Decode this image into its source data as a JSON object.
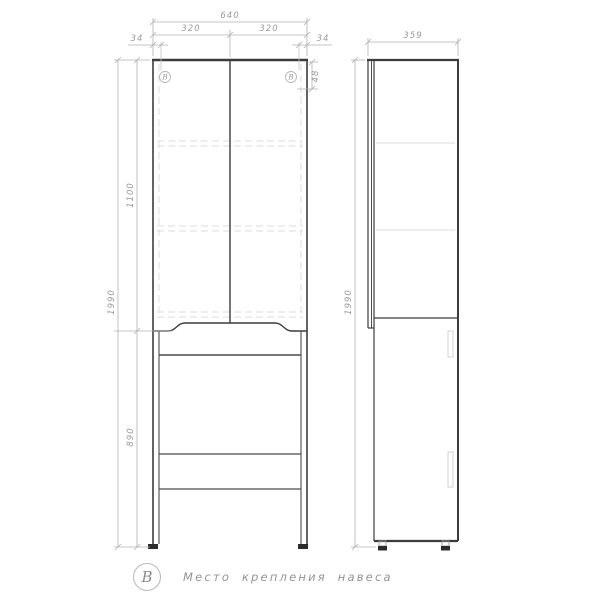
{
  "front_view": {
    "dim_width_total": "640",
    "dim_door_left": "320",
    "dim_door_right": "320",
    "dim_hinge_left": "34",
    "dim_hinge_right": "34",
    "dim_hinge_top": "48",
    "dim_upper_height": "1100",
    "dim_total_height": "1990",
    "dim_lower_height": "890",
    "hinge_mark_left": "В",
    "hinge_mark_right": "В"
  },
  "side_view": {
    "dim_depth": "359",
    "dim_total_height": "1990"
  },
  "legend": {
    "symbol": "В",
    "label": "Место крепления навеса"
  },
  "colors": {
    "outline": "#3c3c3c",
    "dimension": "#a8a8a8",
    "dimension_text": "#9a9a9a",
    "hidden_line": "#dcdcdc",
    "background": "#ffffff"
  }
}
